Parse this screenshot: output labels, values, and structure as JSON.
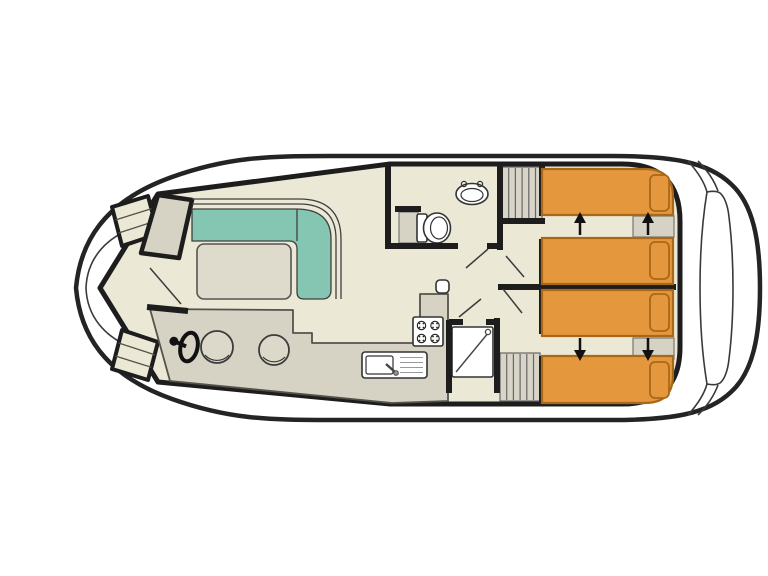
{
  "image": {
    "kind": "boat-deck-floor-plan",
    "background": "#ffffff",
    "width": 768,
    "height": 576,
    "visible_text": ""
  },
  "colors": {
    "hull_outline": "#242424",
    "wall": "#1d1d1d",
    "thin_line": "#3a3a3a",
    "floor": "#ebe8d6",
    "panel_gray": "#d6d3c5",
    "stairs_gray": "#d8d5c8",
    "sofa_teal": "#84c6b1",
    "bed_orange": "#e5973e",
    "bed_border": "#a96818",
    "fixture_white": "#ffffff"
  },
  "plan": {
    "orientation": "bow-left-stern-right",
    "areas": [
      {
        "id": "bow-deck",
        "label": "bow deck with side boarding steps"
      },
      {
        "id": "saloon",
        "label": "saloon with L-shaped sofa, table, helm and two stools"
      },
      {
        "id": "galley",
        "label": "galley with 4-burner stove, sink with drainer and counter"
      },
      {
        "id": "bathroom",
        "label": "bathroom with washbasin, toilet and cabinet"
      },
      {
        "id": "shower",
        "label": "separate shower cabin with tray and shower head"
      },
      {
        "id": "corridor",
        "label": "corridor with five open door swings"
      },
      {
        "id": "cabin-1",
        "label": "aft cabin 1 with two sliding single beds and pillows"
      },
      {
        "id": "cabin-2",
        "label": "aft cabin 2 with two sliding single beds and pillows"
      },
      {
        "id": "stern-deck",
        "label": "stern deck with transom bench and boarding steps"
      }
    ],
    "counts": {
      "beds": 4,
      "pillows": 4,
      "slide_arrows": 4,
      "nightstand_strips": 2,
      "staircases": 2,
      "stools": 2,
      "door_swings": 5,
      "stove_burners": 4
    },
    "icons": [
      "steering-wheel-icon",
      "stove-icon",
      "sink-icon",
      "toilet-icon",
      "washbasin-icon",
      "shower-icon",
      "stairs-icon",
      "bed-slide-arrow-icon"
    ]
  }
}
